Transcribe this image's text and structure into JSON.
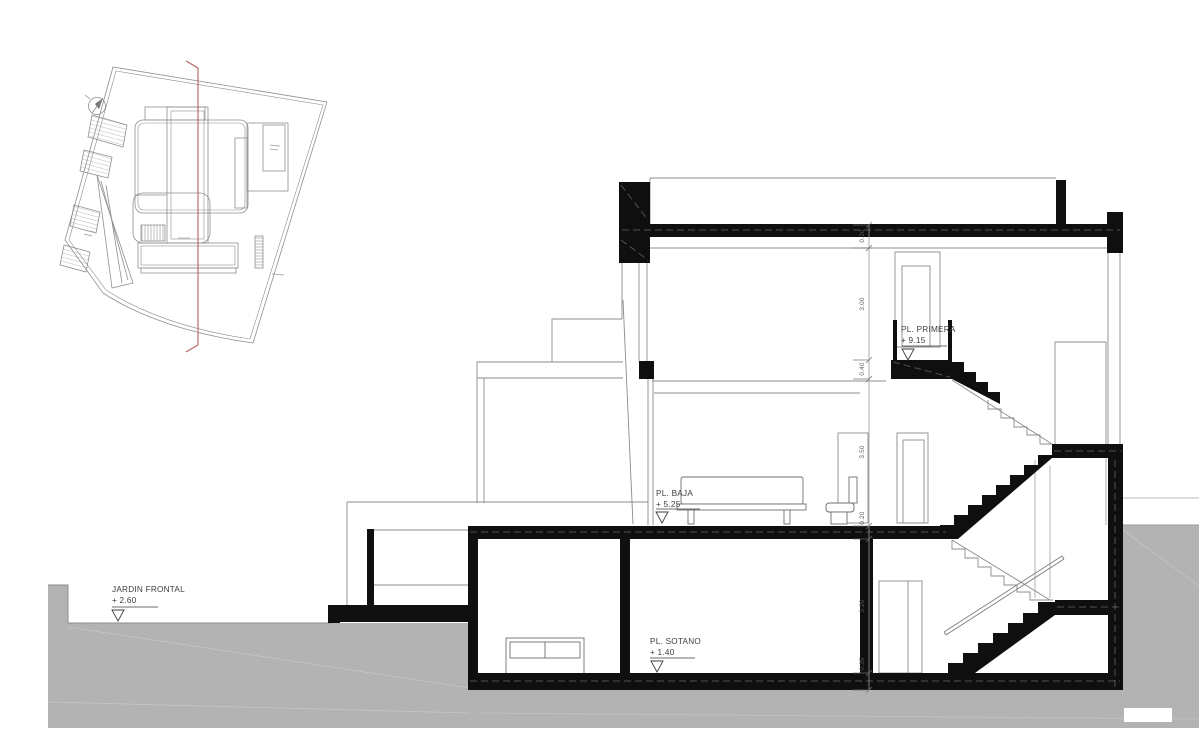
{
  "drawing_title": "house-longitudinal-section-with-site-plan",
  "colors": {
    "ground_fill": "#b3b3b3",
    "cut_black": "#0f0f0f",
    "thin_line": "#8c8c8c",
    "section_line_red": "#b5645a",
    "text": "#3d3d3d"
  },
  "levels": {
    "jardin": {
      "label": "JARDIN FRONTAL",
      "value": "+ 2.60"
    },
    "sotano": {
      "label": "PL. SOTANO",
      "value": "+ 1.40"
    },
    "baja": {
      "label": "PL. BAJA",
      "value": "+ 5.25"
    },
    "primera": {
      "label": "PL. PRIMERA",
      "value": "+ 9.15"
    }
  },
  "dimensions": [
    "0.30",
    "3.00",
    "0.40",
    "3.50",
    "0.20",
    "3.20",
    "0.35"
  ]
}
